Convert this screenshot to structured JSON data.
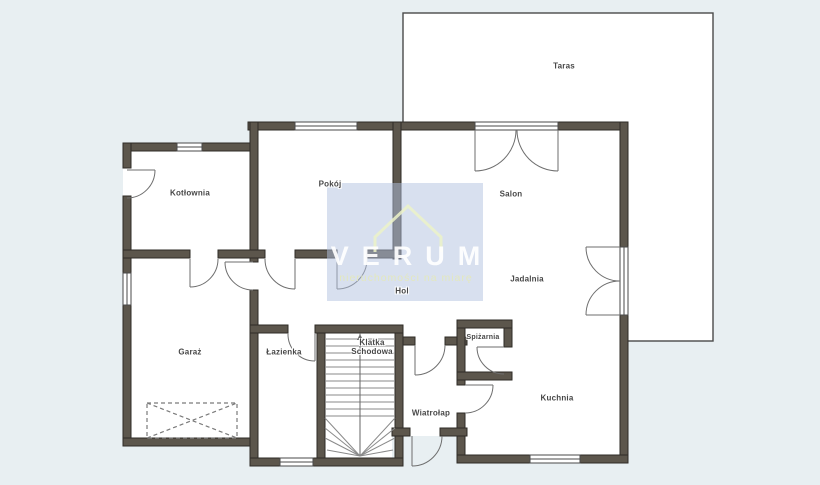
{
  "plan": {
    "type": "floor-plan",
    "watermark": {
      "brand": "VERUM",
      "tagline": "nieruchomości na miarę"
    },
    "rooms": [
      {
        "id": "taras",
        "label": "Taras"
      },
      {
        "id": "kotlownia",
        "label": "Kotłownia"
      },
      {
        "id": "pokoj",
        "label": "Pokój"
      },
      {
        "id": "salon",
        "label": "Salon"
      },
      {
        "id": "jadalnia",
        "label": "Jadalnia"
      },
      {
        "id": "hol",
        "label": "Hol"
      },
      {
        "id": "garaz",
        "label": "Garaż"
      },
      {
        "id": "lazienka",
        "label": "Łazienka"
      },
      {
        "id": "klatka",
        "label": "Klatka\nSchodowa"
      },
      {
        "id": "spizarnia",
        "label": "Spiżarnia"
      },
      {
        "id": "wiatrolap",
        "label": "Wiatrołap"
      },
      {
        "id": "kuchnia",
        "label": "Kuchnia"
      }
    ],
    "colors": {
      "background": "#e8eff2",
      "wall_fill": "#5c564c",
      "wall_outline": "#2e2b26",
      "floor": "#ffffff",
      "thin_line": "#4a4a4a",
      "watermark_overlay": "rgba(178,193,224,0.5)",
      "watermark_brand": "#ffffff",
      "watermark_tagline": "#e4e8ba"
    }
  }
}
